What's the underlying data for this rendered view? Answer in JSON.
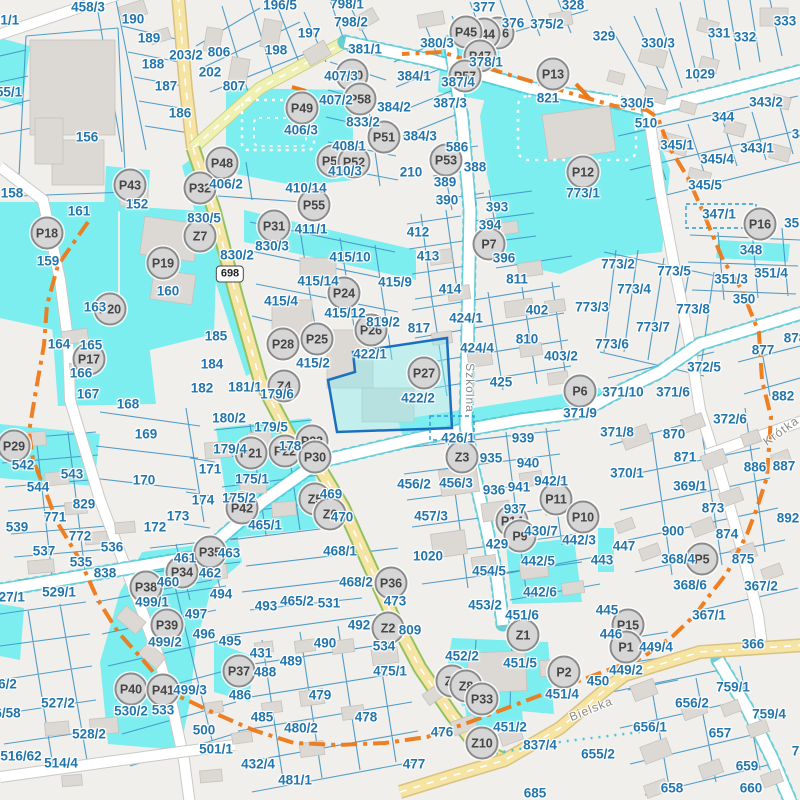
{
  "map": {
    "route_shield": "698",
    "colors": {
      "background": "#f0efec",
      "water": "#7deef0",
      "label": "#2276ad",
      "marker_fill": "#d6d6d6",
      "marker_border": "#8a8a8a",
      "boundary": "#ed7817",
      "parcel_line": "#3f93c4",
      "building": "#dcd9d5",
      "road_yellow": "#f6e4a4",
      "road_lime": "#eef0b4",
      "road_green_edge": "#94c25e",
      "teal_dot": "#49c5d4",
      "highlight_border": "#1b6fc0"
    },
    "streets": [
      {
        "name": "Szkolna",
        "x": 470,
        "y": 388,
        "rotation": 90
      },
      {
        "name": "Bielska",
        "x": 591,
        "y": 709,
        "rotation": -22
      },
      {
        "name": "Krótka",
        "x": 781,
        "y": 431,
        "rotation": -36
      }
    ],
    "markers": [
      [
        "P46",
        498,
        33
      ],
      [
        "P44",
        484,
        34
      ],
      [
        "P45",
        466,
        32
      ],
      [
        "P47",
        480,
        56
      ],
      [
        "P57",
        465,
        76
      ],
      [
        "P50",
        352,
        75
      ],
      [
        "P49",
        302,
        108
      ],
      [
        "P58",
        360,
        99
      ],
      [
        "P51",
        384,
        137
      ],
      [
        "P56",
        344,
        158
      ],
      [
        "P54",
        333,
        161
      ],
      [
        "P52",
        354,
        162
      ],
      [
        "P53",
        446,
        160
      ],
      [
        "P48",
        222,
        163
      ],
      [
        "P43",
        130,
        185
      ],
      [
        "P32",
        200,
        188
      ],
      [
        "P55",
        314,
        205
      ],
      [
        "P13",
        553,
        74
      ],
      [
        "P12",
        583,
        172
      ],
      [
        "P16",
        760,
        224
      ],
      [
        "P18",
        47,
        233
      ],
      [
        "P31",
        274,
        226
      ],
      [
        "Z7",
        200,
        236
      ],
      [
        "P19",
        163,
        263
      ],
      [
        "P7",
        489,
        244
      ],
      [
        "P20",
        110,
        309
      ],
      [
        "P24",
        344,
        293
      ],
      [
        "P26",
        371,
        330
      ],
      [
        "P25",
        317,
        339
      ],
      [
        "P28",
        283,
        344
      ],
      [
        "P17",
        89,
        359
      ],
      [
        "P27",
        424,
        373
      ],
      [
        "Z4",
        284,
        386
      ],
      [
        "P6",
        580,
        391
      ],
      [
        "P29",
        14,
        446
      ],
      [
        "P22",
        285,
        451
      ],
      [
        "P21",
        251,
        453
      ],
      [
        "P23",
        312,
        441
      ],
      [
        "P30",
        315,
        457
      ],
      [
        "Z3",
        462,
        457
      ],
      [
        "P42",
        242,
        508
      ],
      [
        "Z5",
        315,
        499
      ],
      [
        "Z6",
        330,
        514
      ],
      [
        "P11",
        556,
        499
      ],
      [
        "P10",
        583,
        517
      ],
      [
        "P14",
        512,
        521
      ],
      [
        "P9",
        520,
        536
      ],
      [
        "P35",
        210,
        552
      ],
      [
        "P34",
        182,
        572
      ],
      [
        "P36",
        391,
        583
      ],
      [
        "P38",
        146,
        587
      ],
      [
        "P5",
        702,
        559
      ],
      [
        "P39",
        167,
        625
      ],
      [
        "P15",
        628,
        625
      ],
      [
        "P1",
        626,
        647
      ],
      [
        "Z2",
        388,
        628
      ],
      [
        "Z1",
        523,
        635
      ],
      [
        "P2",
        564,
        672
      ],
      [
        "P37",
        239,
        671
      ],
      [
        "Z9",
        452,
        681
      ],
      [
        "Z8",
        466,
        686
      ],
      [
        "P33",
        482,
        699
      ],
      [
        "P40",
        131,
        689
      ],
      [
        "P41",
        163,
        690
      ],
      [
        "Z10",
        482,
        743
      ]
    ],
    "parcel_labels": [
      [
        "458/3",
        88,
        7
      ],
      [
        "01/1",
        6,
        20
      ],
      [
        "190",
        133,
        19
      ],
      [
        "189",
        149,
        38
      ],
      [
        "203/2",
        186,
        55
      ],
      [
        "188",
        153,
        64
      ],
      [
        "187",
        166,
        86
      ],
      [
        "186",
        180,
        113
      ],
      [
        "55/1",
        9,
        92
      ],
      [
        "156",
        87,
        137
      ],
      [
        "158",
        12,
        193
      ],
      [
        "152",
        137,
        204
      ],
      [
        "161",
        79,
        211
      ],
      [
        "159",
        48,
        261
      ],
      [
        "160",
        168,
        291
      ],
      [
        "163",
        95,
        307
      ],
      [
        "164",
        59,
        344
      ],
      [
        "165",
        91,
        345
      ],
      [
        "166",
        81,
        373
      ],
      [
        "167",
        88,
        394
      ],
      [
        "196/5",
        280,
        5
      ],
      [
        "798/1",
        347,
        4
      ],
      [
        "798/2",
        351,
        22
      ],
      [
        "197",
        309,
        33
      ],
      [
        "198",
        276,
        50
      ],
      [
        "806",
        219,
        52
      ],
      [
        "202",
        210,
        72
      ],
      [
        "807",
        234,
        86
      ],
      [
        "381/1",
        365,
        49
      ],
      [
        "407/3",
        341,
        76
      ],
      [
        "407/2",
        336,
        100
      ],
      [
        "833/2",
        363,
        122
      ],
      [
        "406/3",
        301,
        130
      ],
      [
        "406/2",
        226,
        184
      ],
      [
        "408/1",
        349,
        146
      ],
      [
        "410/3",
        345,
        171
      ],
      [
        "410/14",
        306,
        188
      ],
      [
        "411/1",
        311,
        229
      ],
      [
        "830/5",
        204,
        218
      ],
      [
        "830/2",
        237,
        255
      ],
      [
        "830/3",
        272,
        246
      ],
      [
        "415/10",
        350,
        257
      ],
      [
        "415/14",
        318,
        281
      ],
      [
        "415/4",
        281,
        301
      ],
      [
        "415/12",
        345,
        313
      ],
      [
        "819/2",
        383,
        322
      ],
      [
        "415/2",
        313,
        363
      ],
      [
        "422/1",
        370,
        354
      ],
      [
        "185",
        216,
        336
      ],
      [
        "184",
        212,
        364
      ],
      [
        "181/1",
        245,
        387
      ],
      [
        "182",
        202,
        388
      ],
      [
        "179/6",
        277,
        394
      ],
      [
        "377",
        484,
        7
      ],
      [
        "376",
        513,
        23
      ],
      [
        "375/2",
        547,
        24
      ],
      [
        "328",
        573,
        5
      ],
      [
        "380/3",
        437,
        43
      ],
      [
        "378/1",
        486,
        62
      ],
      [
        "384/1",
        414,
        76
      ],
      [
        "387/4",
        458,
        82
      ],
      [
        "387/3",
        450,
        103
      ],
      [
        "384/2",
        394,
        107
      ],
      [
        "384/3",
        420,
        136
      ],
      [
        "586",
        457,
        147
      ],
      [
        "388",
        475,
        167
      ],
      [
        "389",
        445,
        182
      ],
      [
        "390",
        447,
        200
      ],
      [
        "210",
        411,
        172
      ],
      [
        "821",
        548,
        98
      ],
      [
        "773/1",
        583,
        193
      ],
      [
        "393",
        497,
        207
      ],
      [
        "394",
        490,
        225
      ],
      [
        "396",
        504,
        258
      ],
      [
        "412",
        418,
        232
      ],
      [
        "413",
        428,
        256
      ],
      [
        "414",
        450,
        289
      ],
      [
        "811",
        517,
        279
      ],
      [
        "402",
        537,
        310
      ],
      [
        "424/1",
        466,
        318
      ],
      [
        "817",
        419,
        328
      ],
      [
        "424/4",
        477,
        348
      ],
      [
        "810",
        527,
        339
      ],
      [
        "403/2",
        561,
        356
      ],
      [
        "425",
        501,
        382
      ],
      [
        "773/3",
        592,
        307
      ],
      [
        "415/9",
        395,
        282
      ],
      [
        "422/2",
        418,
        398
      ],
      [
        "329",
        604,
        36
      ],
      [
        "330/3",
        658,
        43
      ],
      [
        "331",
        719,
        33
      ],
      [
        "332",
        745,
        37
      ],
      [
        "333",
        785,
        21
      ],
      [
        "1029",
        700,
        74
      ],
      [
        "330/5",
        637,
        103
      ],
      [
        "510",
        646,
        123
      ],
      [
        "343/2",
        766,
        102
      ],
      [
        "344",
        723,
        117
      ],
      [
        "345/1",
        677,
        145
      ],
      [
        "345/4",
        717,
        159
      ],
      [
        "343/1",
        757,
        148
      ],
      [
        "345/5",
        705,
        185
      ],
      [
        "345",
        803,
        134
      ],
      [
        "347/1",
        719,
        214
      ],
      [
        "348",
        751,
        250
      ],
      [
        "351/1",
        801,
        223
      ],
      [
        "773/2",
        618,
        264
      ],
      [
        "773/5",
        674,
        271
      ],
      [
        "773/4",
        634,
        289
      ],
      [
        "351/3",
        731,
        279
      ],
      [
        "351/4",
        771,
        273
      ],
      [
        "350",
        744,
        299
      ],
      [
        "773/8",
        693,
        309
      ],
      [
        "773/7",
        653,
        327
      ],
      [
        "773/6",
        612,
        344
      ],
      [
        "877",
        763,
        350
      ],
      [
        "878",
        795,
        338
      ],
      [
        "372/5",
        704,
        367
      ],
      [
        "371/10",
        623,
        392
      ],
      [
        "371/6",
        673,
        392
      ],
      [
        "882",
        783,
        396
      ],
      [
        "168",
        128,
        404
      ],
      [
        "169",
        146,
        434
      ],
      [
        "170",
        144,
        480
      ],
      [
        "542",
        23,
        465
      ],
      [
        "543",
        72,
        474
      ],
      [
        "544",
        38,
        487
      ],
      [
        "829",
        84,
        504
      ],
      [
        "771",
        55,
        517
      ],
      [
        "539",
        17,
        527
      ],
      [
        "772",
        80,
        536
      ],
      [
        "537",
        44,
        551
      ],
      [
        "536",
        112,
        547
      ],
      [
        "535",
        81,
        562
      ],
      [
        "838",
        105,
        573
      ],
      [
        "529/1",
        59,
        592
      ],
      [
        "527/1",
        8,
        597
      ],
      [
        "173",
        178,
        516
      ],
      [
        "172",
        155,
        527
      ],
      [
        "174",
        203,
        500
      ],
      [
        "180/2",
        229,
        418
      ],
      [
        "179/5",
        271,
        427
      ],
      [
        "179/4",
        230,
        449
      ],
      [
        "178",
        290,
        446
      ],
      [
        "171",
        210,
        469
      ],
      [
        "175/1",
        252,
        479
      ],
      [
        "175/2",
        239,
        498
      ],
      [
        "469",
        331,
        494
      ],
      [
        "470",
        342,
        517
      ],
      [
        "465/1",
        265,
        525
      ],
      [
        "468/1",
        340,
        551
      ],
      [
        "463",
        229,
        553
      ],
      [
        "462",
        210,
        573
      ],
      [
        "461",
        185,
        558
      ],
      [
        "460",
        168,
        582
      ],
      [
        "494",
        221,
        594
      ],
      [
        "468/2",
        356,
        582
      ],
      [
        "473",
        395,
        601
      ],
      [
        "465/2",
        297,
        601
      ],
      [
        "531",
        329,
        603
      ],
      [
        "371/9",
        580,
        413
      ],
      [
        "426/1",
        458,
        438
      ],
      [
        "939",
        523,
        438
      ],
      [
        "935",
        491,
        458
      ],
      [
        "940",
        528,
        463
      ],
      [
        "456/2",
        414,
        484
      ],
      [
        "456/3",
        456,
        483
      ],
      [
        "936",
        494,
        490
      ],
      [
        "941",
        519,
        487
      ],
      [
        "942/1",
        551,
        481
      ],
      [
        "457/3",
        431,
        516
      ],
      [
        "937",
        515,
        509
      ],
      [
        "429",
        497,
        544
      ],
      [
        "430/7",
        541,
        531
      ],
      [
        "442/3",
        579,
        540
      ],
      [
        "1020",
        428,
        556
      ],
      [
        "454/5",
        489,
        571
      ],
      [
        "442/5",
        538,
        561
      ],
      [
        "442/6",
        540,
        592
      ],
      [
        "372/6",
        730,
        419
      ],
      [
        "371/8",
        617,
        432
      ],
      [
        "870",
        674,
        434
      ],
      [
        "871",
        685,
        457
      ],
      [
        "370/1",
        627,
        473
      ],
      [
        "369/1",
        690,
        486
      ],
      [
        "873",
        713,
        508
      ],
      [
        "886",
        755,
        467
      ],
      [
        "887",
        784,
        466
      ],
      [
        "892",
        788,
        518
      ],
      [
        "900",
        673,
        531
      ],
      [
        "874",
        727,
        534
      ],
      [
        "447",
        624,
        546
      ],
      [
        "368/4",
        678,
        559
      ],
      [
        "875",
        743,
        559
      ],
      [
        "368/6",
        690,
        585
      ],
      [
        "367/2",
        761,
        586
      ],
      [
        "443",
        602,
        560
      ],
      [
        "499/1",
        152,
        602
      ],
      [
        "497",
        196,
        614
      ],
      [
        "499/2",
        165,
        642
      ],
      [
        "496",
        204,
        634
      ],
      [
        "495",
        230,
        641
      ],
      [
        "493",
        266,
        606
      ],
      [
        "526/2",
        0,
        684
      ],
      [
        "527/2",
        58,
        703
      ],
      [
        "516/58",
        0,
        713
      ],
      [
        "499/3",
        190,
        690
      ],
      [
        "530/2",
        131,
        711
      ],
      [
        "533",
        163,
        710
      ],
      [
        "528/2",
        89,
        734
      ],
      [
        "516/62",
        21,
        756
      ],
      [
        "514/4",
        61,
        763
      ],
      [
        "500",
        204,
        730
      ],
      [
        "431",
        261,
        653
      ],
      [
        "490",
        325,
        643
      ],
      [
        "534",
        384,
        646
      ],
      [
        "492",
        359,
        625
      ],
      [
        "489",
        291,
        661
      ],
      [
        "488",
        265,
        672
      ],
      [
        "475/1",
        390,
        671
      ],
      [
        "486",
        240,
        695
      ],
      [
        "479",
        320,
        695
      ],
      [
        "485",
        262,
        717
      ],
      [
        "480/2",
        301,
        728
      ],
      [
        "478",
        366,
        717
      ],
      [
        "501/1",
        216,
        749
      ],
      [
        "432/4",
        258,
        764
      ],
      [
        "481/1",
        295,
        780
      ],
      [
        "809",
        410,
        630
      ],
      [
        "453/2",
        485,
        605
      ],
      [
        "451/6",
        522,
        615
      ],
      [
        "452/2",
        462,
        656
      ],
      [
        "451/5",
        520,
        663
      ],
      [
        "451/4",
        562,
        694
      ],
      [
        "451/2",
        510,
        727
      ],
      [
        "476",
        442,
        732
      ],
      [
        "837/4",
        540,
        745
      ],
      [
        "477",
        414,
        764
      ],
      [
        "685",
        535,
        793
      ],
      [
        "655/2",
        598,
        754
      ],
      [
        "450",
        598,
        681
      ],
      [
        "445",
        607,
        610
      ],
      [
        "446",
        611,
        634
      ],
      [
        "449/4",
        656,
        647
      ],
      [
        "367/1",
        709,
        615
      ],
      [
        "366",
        753,
        644
      ],
      [
        "449/2",
        626,
        670
      ],
      [
        "759/1",
        733,
        687
      ],
      [
        "656/2",
        692,
        703
      ],
      [
        "656/1",
        650,
        727
      ],
      [
        "759/4",
        769,
        714
      ],
      [
        "657",
        720,
        733
      ],
      [
        "659",
        747,
        766
      ],
      [
        "658",
        672,
        788
      ],
      [
        "660",
        751,
        788
      ],
      [
        "759",
        803,
        751
      ]
    ]
  }
}
